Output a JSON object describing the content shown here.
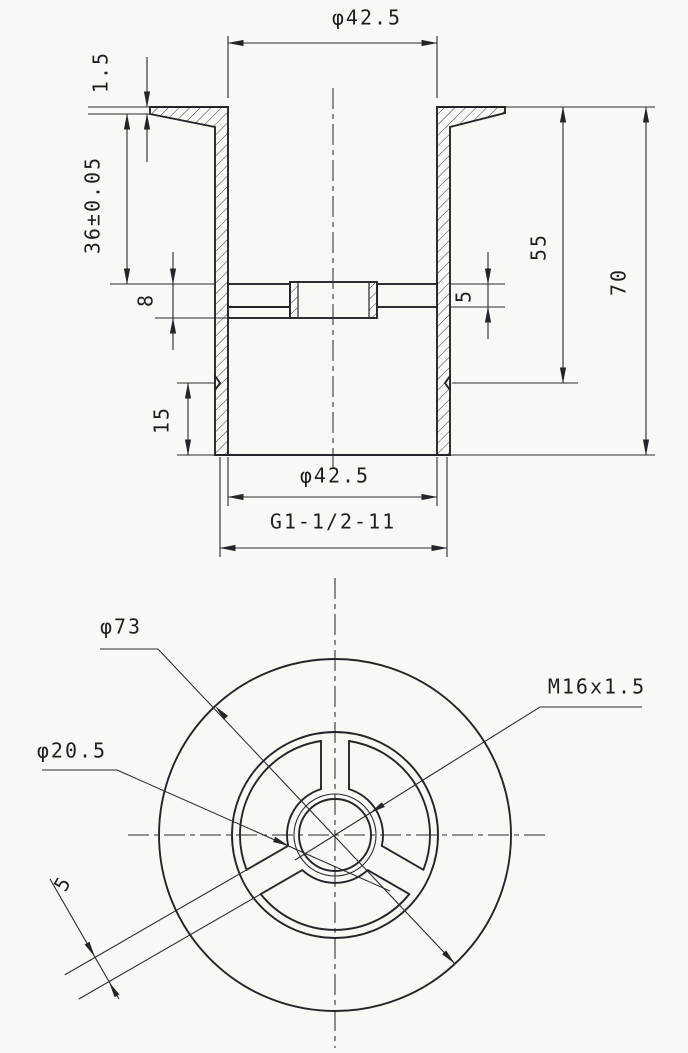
{
  "drawing": {
    "title": "drain-fitting-two-view-drawing",
    "background_color": "#f9f8f4",
    "line_color": "#25242a",
    "section_view": {
      "dim_dia_top": "φ42.5",
      "dim_flange_thickness": "1.5",
      "dim_depth_to_web": "36±0.05",
      "dim_web_left_height": "8",
      "dim_web_right_height": "5",
      "dim_len_to_thread": "55",
      "dim_total_height": "70",
      "dim_thread_length": "15",
      "dim_dia_bottom": "φ42.5",
      "dim_pipe_thread": "G1-1/2-11"
    },
    "plan_view": {
      "dim_dia_outer": "φ73",
      "dim_thread_hole": "M16x1.5",
      "dim_dia_boss": "φ20.5",
      "dim_web_thickness": "5"
    }
  }
}
